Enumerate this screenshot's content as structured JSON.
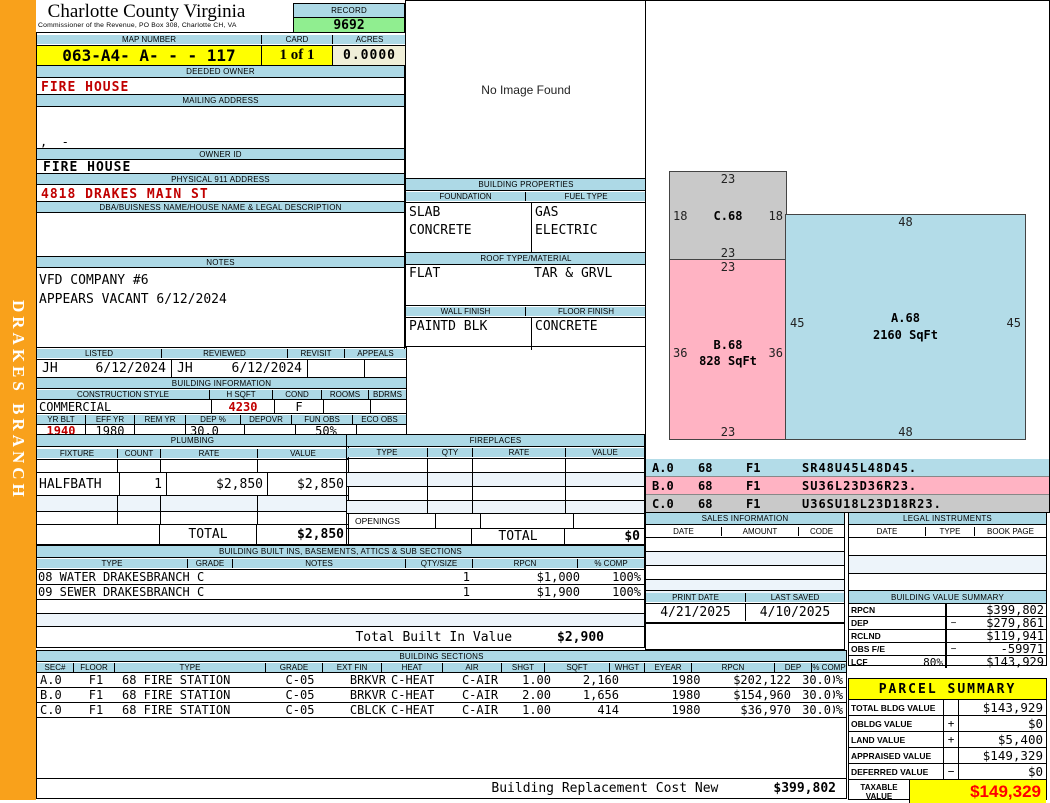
{
  "district": "DRAKES BRANCH",
  "header": {
    "county": "Charlotte County Virginia",
    "commissioner": "Commissioner of the Revenue, PO Box 308, Charlotte CH, VA",
    "record_label": "RECORD",
    "record": "9692",
    "map_number_label": "MAP NUMBER",
    "map_number": "063-A4- A-  -  - 117",
    "card_label": "CARD",
    "card": "1 of 1",
    "acres_label": "ACRES",
    "acres": "0.0000"
  },
  "owner": {
    "deeded_owner_label": "DEEDED OWNER",
    "deeded_owner": "FIRE HOUSE",
    "mailing_address_label": "MAILING ADDRESS",
    "mailing_address": ",  -",
    "owner_id_label": "OWNER ID",
    "owner_id": "FIRE HOUSE",
    "physical_address_label": "PHYSICAL 911 ADDRESS",
    "physical_address": "4818 DRAKES MAIN ST",
    "dba_label": "DBA/BUISNESS NAME/HOUSE NAME & LEGAL DESCRIPTION",
    "dba": "",
    "notes_label": "NOTES",
    "notes_line1": "VFD COMPANY #6",
    "notes_line2": "APPEARS VACANT 6/12/2024"
  },
  "review": {
    "listed_label": "LISTED",
    "listed_by": "JH",
    "listed_date": "6/12/2024",
    "reviewed_label": "REVIEWED",
    "reviewed_by": "JH",
    "reviewed_date": "6/12/2024",
    "revisit_label": "REVISIT",
    "revisit": "",
    "appeals_label": "APPEALS",
    "appeals": ""
  },
  "building_information": {
    "title": "BUILDING INFORMATION",
    "construction_style_label": "CONSTRUCTION STYLE",
    "construction_style": "COMMERCIAL",
    "hsqft_label": "H SQFT",
    "hsqft": "4230",
    "cond_label": "COND",
    "cond": "F",
    "rooms_label": "ROOMS",
    "rooms": "",
    "bdrms_label": "BDRMS",
    "bdrms": "",
    "yr_blt_label": "YR BLT",
    "yr_blt": "1940",
    "eff_yr_label": "EFF YR",
    "eff_yr": "1980",
    "rem_yr_label": "REM YR",
    "rem_yr": "",
    "dep_pct_label": "DEP %",
    "dep_pct": "30.0",
    "depovr_label": "DEPOVR",
    "depovr": "",
    "fun_obs_label": "FUN OBS",
    "fun_obs": "50%",
    "eco_obs_label": "ECO OBS",
    "eco_obs": ""
  },
  "image_panel": {
    "message": "No Image Found"
  },
  "building_properties": {
    "title": "BUILDING PROPERTIES",
    "foundation_label": "FOUNDATION",
    "foundation_line1": "SLAB",
    "foundation_line2": "CONCRETE",
    "fuel_type_label": "FUEL TYPE",
    "fuel_line1": "GAS",
    "fuel_line2": "ELECTRIC",
    "roof_label": "ROOF TYPE/MATERIAL",
    "roof_type": "FLAT",
    "roof_material": "TAR & GRVL",
    "wall_finish_label": "WALL FINISH",
    "wall_finish": "PAINTD BLK",
    "floor_finish_label": "FLOOR FINISH",
    "floor_finish": "CONCRETE"
  },
  "plumbing": {
    "title": "PLUMBING",
    "headers": [
      "FIXTURE",
      "COUNT",
      "RATE",
      "VALUE"
    ],
    "rows": [
      {
        "fixture": "HALFBATH",
        "count": "1",
        "rate": "$2,850",
        "value": "$2,850"
      }
    ],
    "total_label": "TOTAL",
    "total": "$2,850"
  },
  "fireplaces": {
    "title": "FIREPLACES",
    "headers": [
      "TYPE",
      "QTY",
      "RATE",
      "VALUE"
    ],
    "openings_label": "OPENINGS",
    "total_label": "TOTAL",
    "total": "$0"
  },
  "built_ins": {
    "title": "BUILDING BUILT INS, BASEMENTS, ATTICS & SUB SECTIONS",
    "headers": [
      "TYPE",
      "GRADE",
      "NOTES",
      "QTY/SIZE",
      "RPCN",
      "% COMP"
    ],
    "rows": [
      {
        "type": "08 WATER DRAKESBRANCH C",
        "qty": "1",
        "rpcn": "$1,000",
        "comp": "100%"
      },
      {
        "type": "09 SEWER DRAKESBRANCH C",
        "qty": "1",
        "rpcn": "$1,900",
        "comp": "100%"
      }
    ],
    "total_label": "Total Built In Value",
    "total": "$2,900"
  },
  "building_sections": {
    "title": "BUILDING SECTIONS",
    "headers": [
      "SEC#",
      "FLOOR",
      "TYPE",
      "GRADE",
      "EXT FIN",
      "HEAT",
      "AIR",
      "SHGT",
      "SQFT",
      "WHGT",
      "EYEAR",
      "RPCN",
      "DEP",
      "% COMP"
    ],
    "rows": [
      {
        "sec": "A.0",
        "floor": "F1",
        "type": "68 FIRE STATION",
        "grade": "C-05",
        "extfin": "BRKVR",
        "heat": "C-HEAT",
        "air": "C-AIR",
        "shgt": "1.00",
        "sqft": "2,160",
        "whgt": "",
        "eyear": "1980",
        "rpcn": "$202,122",
        "dep": "30.0",
        "comp": "100%"
      },
      {
        "sec": "B.0",
        "floor": "F1",
        "type": "68 FIRE STATION",
        "grade": "C-05",
        "extfin": "BRKVR",
        "heat": "C-HEAT",
        "air": "C-AIR",
        "shgt": "2.00",
        "sqft": "1,656",
        "whgt": "",
        "eyear": "1980",
        "rpcn": "$154,960",
        "dep": "30.0",
        "comp": "100%"
      },
      {
        "sec": "C.0",
        "floor": "F1",
        "type": "68 FIRE STATION",
        "grade": "C-05",
        "extfin": "CBLCK",
        "heat": "C-HEAT",
        "air": "C-AIR",
        "shgt": "1.00",
        "sqft": "414",
        "whgt": "",
        "eyear": "1980",
        "rpcn": "$36,970",
        "dep": "30.0",
        "comp": "100%"
      }
    ],
    "replacement_label": "Building Replacement Cost New",
    "replacement_value": "$399,802"
  },
  "sketch": {
    "shapes": {
      "a": {
        "name": "A.68",
        "sqft": "2160 SqFt",
        "top": "48",
        "bottom": "48",
        "left": "45",
        "right": "45"
      },
      "b": {
        "name": "B.68",
        "sqft": "828 SqFt",
        "top": "23",
        "bottom": "23",
        "left": "36",
        "right": "36"
      },
      "c": {
        "name": "C.68",
        "top": "23",
        "bottom": "23",
        "left": "18",
        "right": "18"
      }
    },
    "legend": [
      {
        "sec": "A.0",
        "code": "68",
        "floor": "F1",
        "vector": "SR48U45L48D45."
      },
      {
        "sec": "B.0",
        "code": "68",
        "floor": "F1",
        "vector": "SU36L23D36R23."
      },
      {
        "sec": "C.0",
        "code": "68",
        "floor": "F1",
        "vector": "U36SU18L23D18R23."
      }
    ]
  },
  "sales_information": {
    "title": "SALES INFORMATION",
    "headers": [
      "DATE",
      "AMOUNT",
      "CODE"
    ]
  },
  "legal_instruments": {
    "title": "LEGAL INSTRUMENTS",
    "headers": [
      "DATE",
      "TYPE",
      "BOOK PAGE"
    ]
  },
  "print_info": {
    "print_date_label": "PRINT DATE",
    "print_date": "4/21/2025",
    "last_saved_label": "LAST SAVED",
    "last_saved": "4/10/2025"
  },
  "building_value_summary": {
    "title": "BUILDING VALUE SUMMARY",
    "rows": [
      {
        "label": "RPCN",
        "pct": "",
        "sign": "",
        "value": "$399,802"
      },
      {
        "label": "DEP",
        "pct": "",
        "sign": "−",
        "value": "$279,861"
      },
      {
        "label": "RCLND",
        "pct": "",
        "sign": "",
        "value": "$119,941"
      },
      {
        "label": "OBS F/E",
        "pct": "",
        "sign": "−",
        "value": "-59971"
      },
      {
        "label": "LCF",
        "pct": "80%",
        "sign": "",
        "value": "$143,929"
      }
    ]
  },
  "parcel_summary": {
    "title": "PARCEL SUMMARY",
    "rows": [
      {
        "label": "TOTAL BLDG VALUE",
        "sign": "",
        "value": "$143,929"
      },
      {
        "label": "OBLDG VALUE",
        "sign": "+",
        "value": "$0"
      },
      {
        "label": "LAND VALUE",
        "sign": "+",
        "value": "$5,400"
      },
      {
        "label": "APPRAISED VALUE",
        "sign": "",
        "value": "$149,329"
      },
      {
        "label": "DEFERRED VALUE",
        "sign": "−",
        "value": "$0"
      }
    ],
    "taxable_label_line1": "TAXABLE",
    "taxable_label_line2": "VALUE",
    "taxable_value": "$149,329"
  },
  "colors": {
    "band_blue": "#add9e6",
    "record_green": "#90ee90",
    "highlight_yellow": "#ffff00",
    "acres_cream": "#f0efd8",
    "sidebar_orange": "#f9a11b",
    "alert_red": "#c00000",
    "taxable_red": "#ff0000",
    "sketch_a_blue": "#b3dce8",
    "sketch_b_pink": "#ffb3c3",
    "sketch_c_gray": "#c9c9c9"
  }
}
